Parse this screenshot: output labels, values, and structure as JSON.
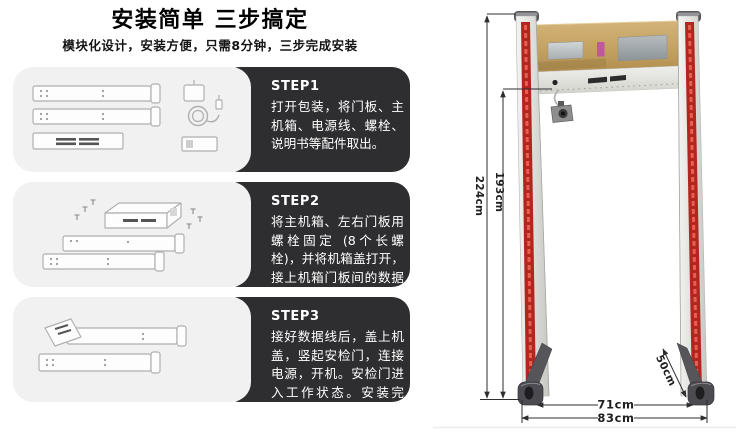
{
  "header": {
    "title": "安装简单 三步搞定",
    "subtitle": "模块化设计，安装方便，只需8分钟，三步完成安装"
  },
  "steps": [
    {
      "label": "STEP1",
      "text": "打开包装，将门板、主机箱、电源线、螺栓、说明书等配件取出。"
    },
    {
      "label": "STEP2",
      "text": "将主机箱、左右门板用螺栓固定 (8个长螺栓)，并将机箱盖打开，接上机箱门板间的数据线。"
    },
    {
      "label": "STEP3",
      "text": "接好数据线后，盖上机盖，竖起安检门，连接电源，开机。安检门进入工作状态。安装完成。"
    }
  ],
  "product": {
    "dimensions": {
      "total_height": "224cm",
      "inner_height": "193cm",
      "inner_width": "71cm",
      "outer_width": "83cm",
      "base_depth": "50cm"
    },
    "colors": {
      "step_box": "#2e2e30",
      "illustration_panel": "#f1f1f1",
      "crossbar_tan": "#c4a263",
      "led_red": "#b3261f"
    }
  }
}
